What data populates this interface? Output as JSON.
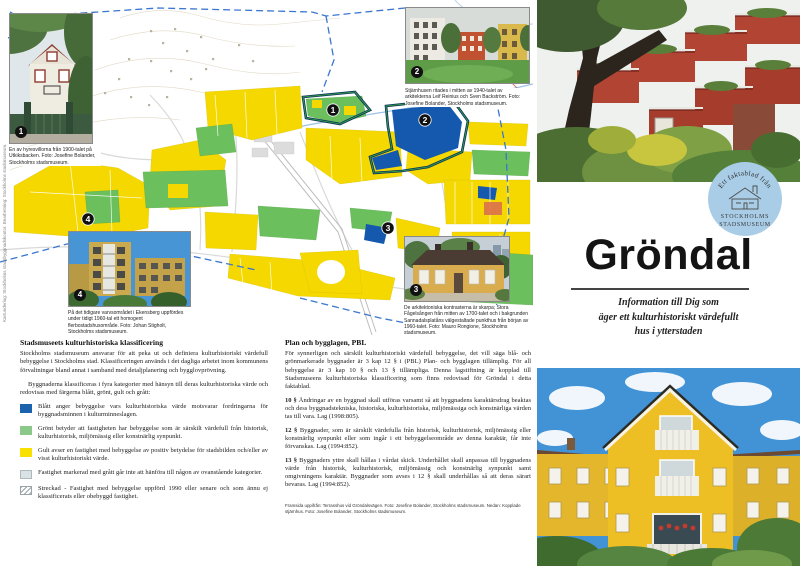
{
  "colors": {
    "map_yellow": "#f5d800",
    "map_green": "#6bbf5d",
    "map_blue": "#1459ae",
    "area_outline_navy": "#0d2f5e",
    "area_outline_green": "#2f9a44",
    "boundary_dash_blue": "#3a76d0",
    "legend_blue": "#1c63ad",
    "legend_green": "#8cc88a",
    "legend_yellow": "#f8e000",
    "legend_gray": "#dbe2e5",
    "stamp_blue": "#a9cde7"
  },
  "map": {
    "credit_vertical": "Kartunderlag: Stockholms stadsbyggnadskontor. Bearbetning: Stockholms stadsmuseum.",
    "markers": [
      {
        "label": "1"
      },
      {
        "label": "2"
      },
      {
        "label": "3"
      },
      {
        "label": "4"
      }
    ]
  },
  "photos": {
    "p1": {
      "num": "1",
      "caption": "En av hyresvillorna från 1900-talet på Utkiksbacken. Foto: Josefine Bolander, Stockholms stadsmuseum."
    },
    "p2": {
      "num": "2",
      "caption": "Stjärnhusen ritades i mitten av 1940-talet av arkitekterna Leif Reinius och Sven Backström. Foto: Josefine Bolander, Stockholms stadsmuseum."
    },
    "p3": {
      "num": "3",
      "caption": "De arkitektoniska kontrasterna är skarpa; Stora Fågelsången från mitten av 1700-talet och i bakgrunden Sannadalsplatåns välgestaltade punkthus från början av 1960-talet. Foto: Mauro Rongione, Stockholms stadsmuseum."
    },
    "p4": {
      "num": "4",
      "caption": "På det tidigare varvsområdet i Ekensberg uppfördes under tidigt 1960-tal ett homogent flerbostadshusområde. Foto: Johan Stigholt, Stockholms stadsmuseum."
    }
  },
  "classification": {
    "heading": "Stadsmuseets kulturhistoriska klassificering",
    "intro1": "Stockholms stadsmuseum ansvarar för att peka ut och definiera kulturhistoriskt värdefull bebyggelse i Stockholms stad. Klassificeringen används i det dagliga arbetet inom kommunens förvaltningar bland annat i samband med detaljplanering och bygglovprövning.",
    "intro2": "Byggnaderna klassificeras i fyra kategorier med hänsyn till deras kulturhistoriska värde och redovisas med färgerna blått, grönt, gult och grått:",
    "legend": [
      {
        "key": "blue",
        "text": "Blått anger bebyggelse vars kulturhistoriska värde motsvarar fordringarna för byggnadsminnen i kulturminneslagen."
      },
      {
        "key": "green",
        "text": "Grönt betyder att fastigheten har bebyggelse som är särskilt värdefull från historisk, kulturhistorisk, miljömässig eller konstnärlig synpunkt."
      },
      {
        "key": "yellow",
        "text": "Gult avser en fastighet med bebyggelse av positiv betydelse för stadsbilden och/eller av visst kulturhistoriskt värde."
      },
      {
        "key": "gray",
        "text": "Fastighet markerad med grått går inte att hänföra till någon av ovanstående kategorier."
      },
      {
        "key": "hatched",
        "text": "Streckad - Fastighet med bebyggelse uppförd 1990 eller senare och som ännu ej klassificerats eller obebyggd fastighet."
      }
    ]
  },
  "pbl": {
    "heading": "Plan och bygglagen, PBL",
    "p1": "För synnerligen och särskilt kulturhistoriskt värdefull bebyggelse, det vill säga blå- och grönmarkerade byggnader är 3 kap 12 § i (PBL) Plan- och bygglagen tillämplig. För all bebyggelse är 3 kap 10 § och 13 § tillämpliga. Denna lagstiftning är kopplad till Stadsmuseens kulturhistoriska klassificering som finns redovisad för Gröndal i detta faktablad.",
    "sections": [
      {
        "lead": "10 §",
        "text": "Ändringar av en byggnad skall utföras varsamt så att byggnadens karaktärsdrag beaktas och dess byggnadstekniska, historiska, kulturhistoriska, miljömässiga och konstnärliga värden tas till vara. Lag (1998:805)."
      },
      {
        "lead": "12 §",
        "text": "Byggnader, som är särskilt värdefulla från historisk, kulturhistorisk, miljömässig eller konstnärlig synpunkt eller som ingår i ett bebyggelseområde av denna karaktär, får inte förvanskas. Lag (1994:852)."
      },
      {
        "lead": "13 §",
        "text": "Byggnaders yttre skall hållas i vårdat skick. Underhållet skall anpassas till byggnadens värde från historisk, kulturhistorisk, miljömässig och konstnärlig synpunkt samt omgivningens karaktär. Byggnader som avses i 12 § skall underhållas så att deras särart bevaras. Lag (1994:852)."
      }
    ],
    "credits": "Framsida uppifrån: Terrasshus vid Gröndalsvägen. Foto: Josefine Bolander, Stockholms stadsmuseum. Nedan: Kopplade stjärnhus. Foto: Josefine Bolander, Stockholms stadsmuseum."
  },
  "cover": {
    "stamp_arc": "Ett faktablad från",
    "stamp_line1": "STOCKHOLMS",
    "stamp_line2": "STADSMUSEUM",
    "title": "Gröndal",
    "subtitle_line1": "Information till Dig som",
    "subtitle_line2": "äger ett kulturhistoriskt värdefullt",
    "subtitle_line3": "hus i ytterstaden"
  }
}
